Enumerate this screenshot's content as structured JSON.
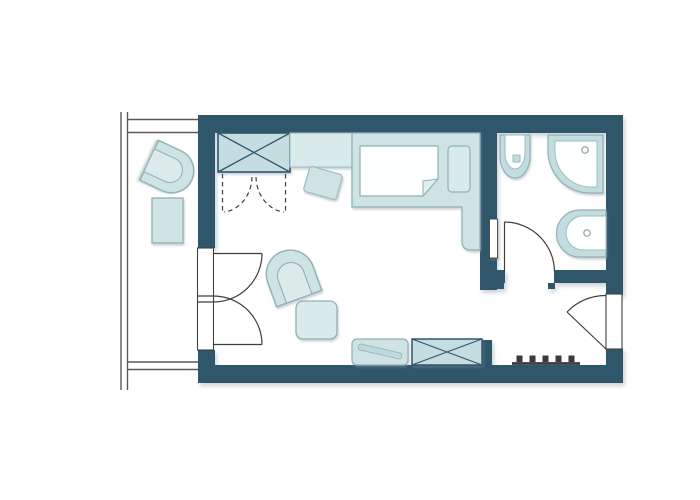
{
  "plan": {
    "type": "apartment-floor-plan",
    "rooms": [
      "balcony",
      "bedroom",
      "bathroom",
      "entrance-hall"
    ],
    "furniture": [
      "wardrobe",
      "desk",
      "desk-chair",
      "single-bed",
      "duvet",
      "pillow",
      "bedside-ledge",
      "armchair",
      "side-table",
      "luggage-bench",
      "storage-cabinet",
      "balcony-armchair",
      "balcony-table"
    ],
    "fixtures": [
      "toilet",
      "shower",
      "washbasin",
      "radiator",
      "wall-mirror"
    ],
    "doors": [
      "balcony-double-door",
      "bathroom-door",
      "entrance-door",
      "wardrobe-folding-doors"
    ]
  },
  "colors": {
    "wall": "#30566C",
    "fill": "#CFE3E4",
    "fill_alt": "#D9EAEA",
    "fill_sat": "#C5DDE1",
    "fixture": "#C3DCDF",
    "seat_inner": "#DCEBEA",
    "stroke_light": "#8FB2B6",
    "stroke_mid": "#9FBEC2",
    "white": "#FDFEFE",
    "fold": "#E3EFEE",
    "stripe": "#C0DADB",
    "line_door": "#3F3F3F",
    "line_thin": "#5A5A5A",
    "drain": "#8C9EA6",
    "radiator": "#3A3A3A"
  }
}
